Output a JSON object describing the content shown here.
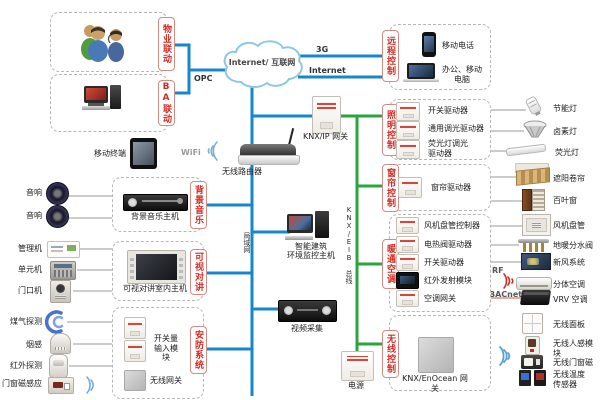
{
  "palette": {
    "line_blue": "#1787cd",
    "line_green": "#2aa53e",
    "label_red": "#d42a22",
    "thin_line": "#999999",
    "bacnet_line": "#b85c4c"
  },
  "cloud_label": "Internet/ 互联网",
  "net": {
    "g3": "3G",
    "internet": "Internet",
    "opc": "OPC",
    "wifi": "WiFi",
    "rf": "RF",
    "bacnet": "BACnet",
    "lan": "局域网",
    "knx_bus": "KNX/EIB 总线"
  },
  "groups": {
    "property": "物业联动",
    "ba": "BA联动",
    "remote": "远程控制",
    "lighting": "照明控制",
    "curtain": "窗帘控制",
    "hvac": "暖通空调",
    "wireless": "无线控制",
    "bgm": "背景音乐",
    "intercom": "可视对讲",
    "security": "安防系统"
  },
  "devices": {
    "mobile_phone": "移动电话",
    "office_pc": "办公、移动电脑",
    "mobile_terminal": "移动终端",
    "router": "无线路由器",
    "knx_ip_gateway": "KNX/IP 网关",
    "env_host_l1": "智能建筑",
    "env_host_l2": "环境监控主机",
    "video_capture": "视频采集",
    "power": "电源",
    "enocean_gateway": "KNX/EnOcean 网关",
    "bgm_host": "背景音乐主机",
    "intercom_host": "可视对讲室内主机"
  },
  "left_items": [
    "音响",
    "音响",
    "管理机",
    "单元机",
    "门口机",
    "煤气探测",
    "烟感",
    "红外探测",
    "门窗磁感应"
  ],
  "lighting_items": [
    "开关驱动器",
    "通用调光驱动器",
    "荧光灯调光驱动器"
  ],
  "curtain_items": [
    "窗帘驱动器"
  ],
  "hvac_items": [
    "风机盘管控制器",
    "电热阀驱动器",
    "开关驱动器",
    "红外发射模块",
    "空调网关"
  ],
  "security_items": [
    "开关量输入模块",
    "无线网关"
  ],
  "right_items": [
    "节能灯",
    "卤素灯",
    "荧光灯",
    "遮阳卷帘",
    "百叶窗",
    "风机盘管",
    "地暖分水阀",
    "新风系统",
    "分体空调",
    "VRV 空调",
    "无线面板",
    "无线人感模块",
    "无线门窗磁",
    "无线温度传感器"
  ]
}
